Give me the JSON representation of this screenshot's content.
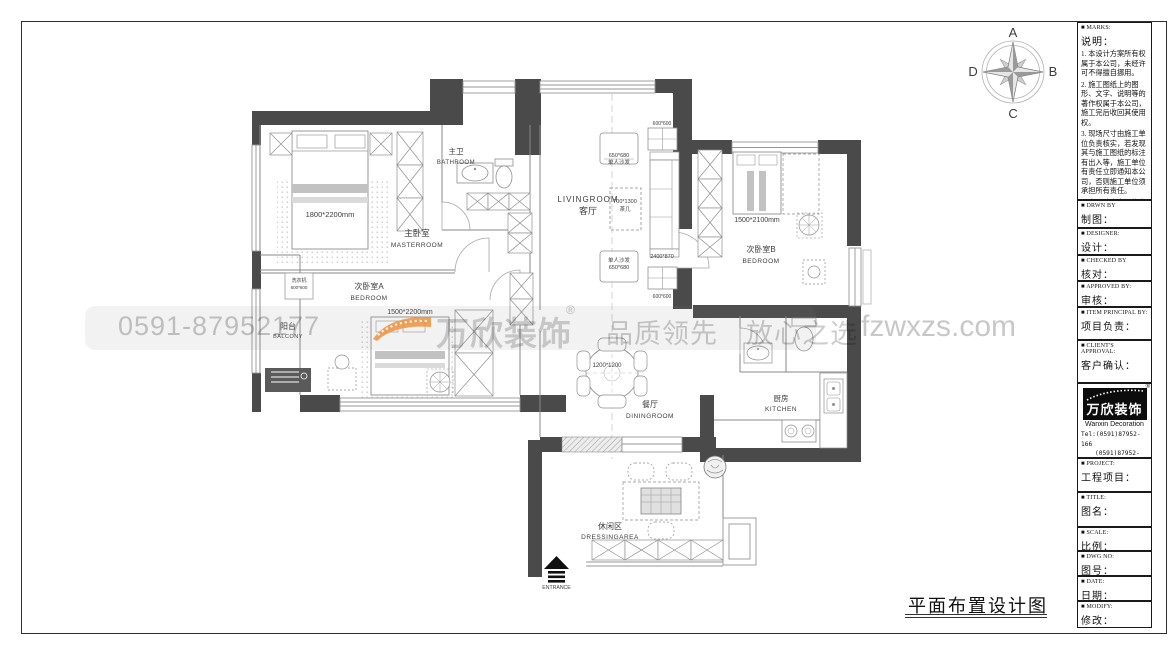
{
  "sheet": {
    "title": "平面布置设计图"
  },
  "compass": {
    "n": "A",
    "e": "B",
    "s": "C",
    "w": "D"
  },
  "watermark": {
    "phone": "0591-87952177",
    "brand": "万欣装饰",
    "registered": "®",
    "slogan": "品质领先　放心之选",
    "website": "fzwxzs.com"
  },
  "plan": {
    "master": {
      "cn": "主卧室",
      "en": "MASTERROOM",
      "bed_dim": "1800*2200mm"
    },
    "bathroom": {
      "cn": "主卫",
      "en": "BATHROOM"
    },
    "living": {
      "cn": "客厅",
      "en": "LIVINGROOM",
      "armchair": "单人沙发",
      "armchair_dim": "650*680",
      "coffee_table": "茶几",
      "coffee_table_dim": "700*1300",
      "sofa_dim": "2400*870",
      "side_table_dim": "600*600"
    },
    "bedroom_a": {
      "cn": "次卧室A",
      "en": "BEDROOM",
      "bed_dim": "1500*2200mm"
    },
    "bedroom_b": {
      "cn": "次卧室B",
      "en": "BEDROOM",
      "bed_dim": "1500*2100mm"
    },
    "balcony": {
      "cn": "阳台",
      "en": "BALCONY",
      "washer": "洗衣机",
      "washer_dim": "600*600"
    },
    "dining": {
      "cn": "餐厅",
      "en": "DININGROOM",
      "table_dim": "1200*1200"
    },
    "kitchen": {
      "cn": "厨房",
      "en": "KITCHEN"
    },
    "dressing": {
      "cn": "休闲区",
      "en": "DRESSINGAREA"
    },
    "entrance": "ENTRANCE"
  },
  "titleblock": {
    "marks": {
      "en": "■ MARKS:",
      "cn": "说明：",
      "notes": [
        "1. 本设计方案所有权属于本公司，未经许可不得擅自挪用。",
        "2. 施工图纸上的图形、文字、说明等的著作权属于本公司，施工完后收回其使用权。",
        "3. 现场尺寸由施工单位负责核实，若发现其与施工图纸的标注有出入等，施工单位有责任立即通知本公司，否则施工单位须承担所有责任。",
        "4. 本设计方案是依客户要求设计，经客户签字即视为同意认可，不得随意更改。"
      ]
    },
    "drawn": {
      "en": "■ DRWN BY",
      "cn": "制图："
    },
    "designer": {
      "en": "■ DESIGNER:",
      "cn": "设计："
    },
    "checked": {
      "en": "■ CHECKED BY",
      "cn": "核对："
    },
    "approved": {
      "en": "■ APPROVED BY:",
      "cn": "审核："
    },
    "principal": {
      "en": "■ ITEM PRINCIPAL BY:",
      "cn": "项目负责："
    },
    "client": {
      "en": "■ CLIENT'S APPROVAL:",
      "cn": "客户确认："
    },
    "logo": {
      "brand": "万欣装饰",
      "reg": "®",
      "sub": "Wanxin Decoration",
      "tel1": "Tel:(0591)87952-166",
      "tel2": "(0591)87952-177",
      "fax": "Fax:(0591)87952-199",
      "web": "Web:WWW.fzwxzs.com"
    },
    "project": {
      "en": "■ PROJECT:",
      "cn": "工程项目："
    },
    "title": {
      "en": "■ TITLE:",
      "cn": "图名："
    },
    "scale": {
      "en": "■ SCALE:",
      "cn": "比例："
    },
    "dwg_no": {
      "en": "■ DWG NO:",
      "cn": "图号："
    },
    "date": {
      "en": "■ DATE:",
      "cn": "日期："
    },
    "modify": {
      "en": "■ MODIFY:",
      "cn": "修改："
    }
  },
  "colors": {
    "wall": "#4a4a4a",
    "accent_orange": "#ef9340",
    "watermark_gray": "#c8c8c8"
  }
}
